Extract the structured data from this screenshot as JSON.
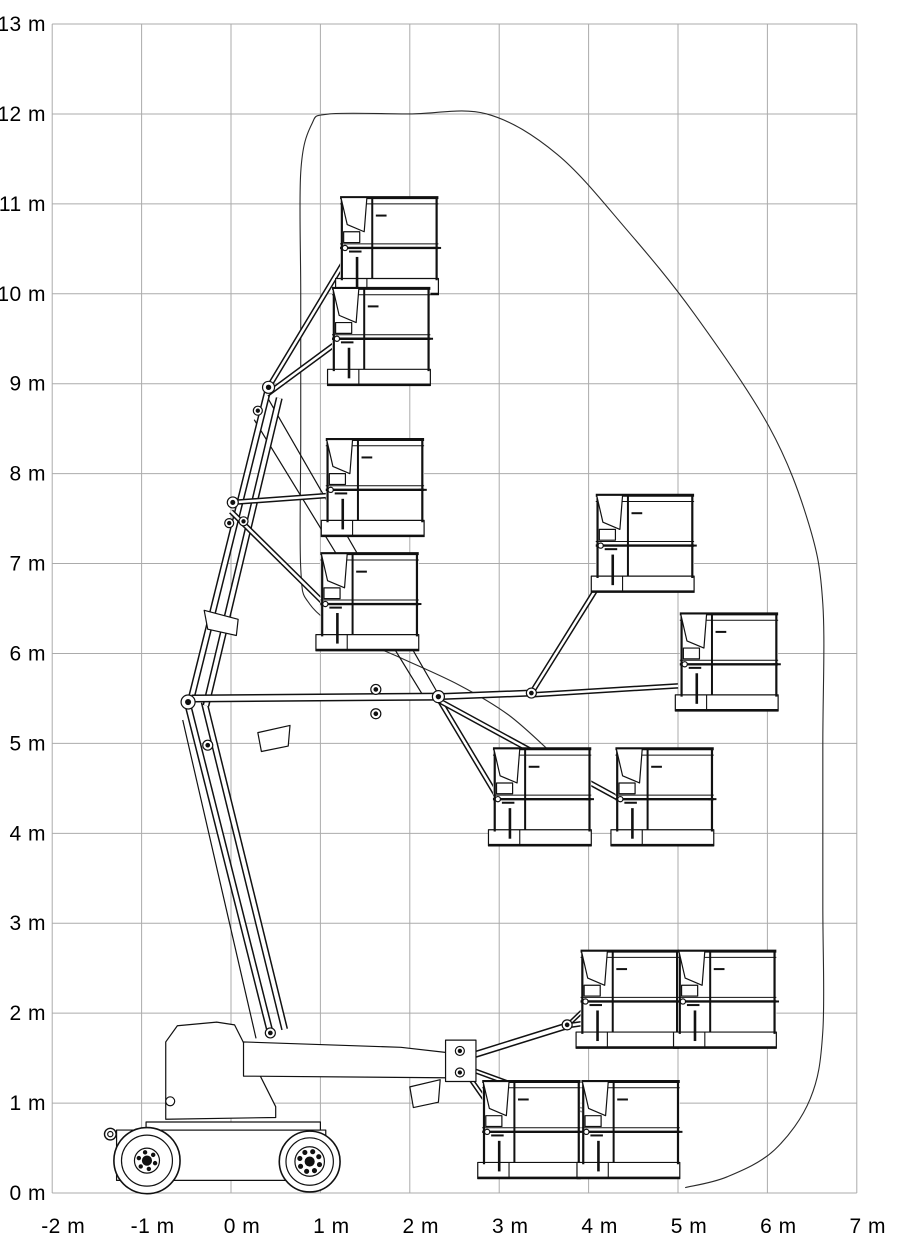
{
  "diagram": {
    "type": "working-range-envelope",
    "units": "m",
    "x_axis": {
      "ticks": [
        {
          "value": -2,
          "label": "-2 m"
        },
        {
          "value": -1,
          "label": "-1 m"
        },
        {
          "value": 0,
          "label": "0 m"
        },
        {
          "value": 1,
          "label": "1 m"
        },
        {
          "value": 2,
          "label": "2 m"
        },
        {
          "value": 3,
          "label": "3 m"
        },
        {
          "value": 4,
          "label": "4 m"
        },
        {
          "value": 5,
          "label": "5 m"
        },
        {
          "value": 6,
          "label": "6 m"
        },
        {
          "value": 7,
          "label": "7 m"
        }
      ]
    },
    "y_axis": {
      "ticks": [
        {
          "value": 0,
          "label": "0 m"
        },
        {
          "value": 1,
          "label": "1 m"
        },
        {
          "value": 2,
          "label": "2 m"
        },
        {
          "value": 3,
          "label": "3 m"
        },
        {
          "value": 4,
          "label": "4 m"
        },
        {
          "value": 5,
          "label": "5 m"
        },
        {
          "value": 6,
          "label": "6 m"
        },
        {
          "value": 7,
          "label": "7 m"
        },
        {
          "value": 8,
          "label": "8 m"
        },
        {
          "value": 9,
          "label": "9 m"
        },
        {
          "value": 10,
          "label": "10 m"
        },
        {
          "value": 11,
          "label": "11 m"
        },
        {
          "value": 12,
          "label": "12 m"
        },
        {
          "value": 13,
          "label": "13 m"
        }
      ]
    },
    "colors": {
      "grid": "#ababab",
      "ink": "#111111",
      "envelope": "#2a2a2a",
      "paper": "#ffffff"
    },
    "envelope_m": [
      [
        3.58,
        4.9
      ],
      [
        3.1,
        5.32
      ],
      [
        2.55,
        5.65
      ],
      [
        1.9,
        5.95
      ],
      [
        1.3,
        6.22
      ],
      [
        0.88,
        6.55
      ],
      [
        0.78,
        6.95
      ],
      [
        0.78,
        8.4
      ],
      [
        0.78,
        10.0
      ],
      [
        0.78,
        11.35
      ],
      [
        0.9,
        11.88
      ],
      [
        1.1,
        12.0
      ],
      [
        2.0,
        12.0
      ],
      [
        2.86,
        12.0
      ],
      [
        3.65,
        11.55
      ],
      [
        4.42,
        10.72
      ],
      [
        5.18,
        9.78
      ],
      [
        6.02,
        8.52
      ],
      [
        6.46,
        7.45
      ],
      [
        6.62,
        6.55
      ],
      [
        6.62,
        5.0
      ],
      [
        6.62,
        3.2
      ],
      [
        6.62,
        1.8
      ],
      [
        6.48,
        1.05
      ],
      [
        6.08,
        0.48
      ],
      [
        5.55,
        0.18
      ],
      [
        5.08,
        0.06
      ]
    ],
    "baskets": {
      "width": 1.1,
      "rail_height": 1.08,
      "positions": [
        {
          "x": 1.22,
          "floor": 9.99
        },
        {
          "x": 1.13,
          "floor": 8.98
        },
        {
          "x": 1.06,
          "floor": 7.3
        },
        {
          "x": 1.0,
          "floor": 6.03
        },
        {
          "x": 4.08,
          "floor": 6.68
        },
        {
          "x": 5.02,
          "floor": 5.36
        },
        {
          "x": 2.93,
          "floor": 3.86
        },
        {
          "x": 4.3,
          "floor": 3.86
        },
        {
          "x": 3.91,
          "floor": 1.61
        },
        {
          "x": 5.0,
          "floor": 1.61
        },
        {
          "x": 2.81,
          "floor": 0.16
        },
        {
          "x": 3.92,
          "floor": 0.16
        }
      ]
    },
    "machine": {
      "booms": [
        [
          0.44,
          1.78,
          -0.48,
          5.42,
          7
        ],
        [
          0.6,
          1.82,
          -0.3,
          5.46,
          7
        ],
        [
          -0.44,
          5.52,
          0.42,
          8.96,
          7
        ],
        [
          -0.28,
          5.42,
          0.54,
          8.84,
          7
        ],
        [
          -0.44,
          5.5,
          2.32,
          5.52,
          8
        ],
        [
          2.32,
          5.52,
          3.36,
          5.56,
          7
        ],
        [
          0.42,
          8.96,
          1.28,
          10.38,
          5.5
        ],
        [
          0.4,
          8.88,
          1.19,
          9.46,
          5.5
        ],
        [
          0.02,
          7.68,
          1.12,
          7.76,
          5.5
        ],
        [
          0.0,
          7.58,
          1.06,
          6.54,
          5.5
        ],
        [
          3.36,
          5.56,
          4.15,
          6.82,
          5.5
        ],
        [
          3.36,
          5.54,
          5.0,
          5.64,
          5.5
        ],
        [
          2.32,
          5.5,
          2.97,
          4.42,
          5.5
        ],
        [
          2.32,
          5.48,
          4.35,
          4.38,
          5.5
        ],
        [
          2.6,
          1.5,
          3.76,
          1.86,
          7
        ],
        [
          3.76,
          1.86,
          3.97,
          2.06,
          4.5
        ],
        [
          3.76,
          1.86,
          5.03,
          2.04,
          5.5
        ],
        [
          2.56,
          1.44,
          2.91,
          0.94,
          5
        ],
        [
          2.56,
          1.42,
          3.99,
          0.9,
          5
        ]
      ],
      "rods": [
        [
          0.4,
          8.86,
          2.3,
          5.58,
          1.2
        ],
        [
          0.26,
          8.6,
          2.18,
          5.48,
          1.2
        ],
        [
          -0.54,
          5.26,
          0.28,
          1.72,
          1.2
        ],
        [
          0.03,
          1.87,
          0.36,
          0.9,
          1.1
        ],
        [
          0.2,
          1.47,
          2.46,
          1.42,
          1.1
        ],
        [
          -0.68,
          1.43,
          -0.55,
          1.47,
          1.6
        ],
        [
          -0.68,
          1.52,
          -0.55,
          1.56,
          1.6
        ],
        [
          -0.68,
          1.61,
          -0.55,
          1.65,
          1.6
        ],
        [
          -0.68,
          1.7,
          -0.55,
          1.74,
          1.6
        ]
      ],
      "polygons": [
        [
          [
            -1.28,
            0.14
          ],
          [
            -1.28,
            0.7
          ],
          [
            1.06,
            0.7
          ],
          [
            1.06,
            0.42
          ],
          [
            0.98,
            0.14
          ]
        ],
        [
          [
            -0.95,
            0.7
          ],
          [
            -0.95,
            0.79
          ],
          [
            1.0,
            0.79
          ],
          [
            1.0,
            0.7
          ]
        ],
        [
          [
            -0.73,
            0.82
          ],
          [
            -0.73,
            1.68
          ],
          [
            -0.6,
            1.86
          ],
          [
            -0.16,
            1.9
          ],
          [
            0.04,
            1.87
          ],
          [
            0.5,
            0.96
          ],
          [
            0.5,
            0.84
          ]
        ],
        [
          [
            0.14,
            1.3
          ],
          [
            0.14,
            1.68
          ],
          [
            1.9,
            1.62
          ],
          [
            2.52,
            1.55
          ],
          [
            2.52,
            1.28
          ]
        ],
        [
          [
            2.4,
            1.24
          ],
          [
            2.4,
            1.7
          ],
          [
            2.74,
            1.7
          ],
          [
            2.74,
            1.24
          ]
        ],
        [
          [
            -0.3,
            6.48
          ],
          [
            0.08,
            6.38
          ],
          [
            0.06,
            6.2
          ],
          [
            -0.26,
            6.27
          ]
        ],
        [
          [
            0.3,
            5.12
          ],
          [
            0.66,
            5.2
          ],
          [
            0.64,
            4.97
          ],
          [
            0.34,
            4.91
          ]
        ],
        [
          [
            2.0,
            1.18
          ],
          [
            2.34,
            1.26
          ],
          [
            2.32,
            1.01
          ],
          [
            2.04,
            0.95
          ]
        ]
      ],
      "pivots": [
        [
          0.42,
          8.96,
          6
        ],
        [
          0.3,
          8.7,
          4.5
        ],
        [
          0.02,
          7.68,
          5.5
        ],
        [
          0.14,
          7.47,
          4.5
        ],
        [
          -0.02,
          7.45,
          4.5
        ],
        [
          -0.48,
          5.46,
          7
        ],
        [
          -0.26,
          4.98,
          5
        ],
        [
          2.32,
          5.52,
          6
        ],
        [
          3.36,
          5.56,
          5
        ],
        [
          1.62,
          5.6,
          5
        ],
        [
          1.62,
          5.33,
          5
        ],
        [
          2.56,
          1.58,
          4.5
        ],
        [
          2.56,
          1.34,
          4.5
        ],
        [
          3.76,
          1.87,
          5
        ],
        [
          0.44,
          1.78,
          5
        ]
      ],
      "wheels": [
        {
          "c": [
            -0.94,
            0.36
          ],
          "r": 0.37,
          "rings": [
            0.285,
            0.14
          ],
          "hub": 0.05,
          "bolts": 6,
          "bolt_rad": 0.095,
          "bolt_r": 0.018
        },
        {
          "c": [
            0.88,
            0.35
          ],
          "r": 0.34,
          "rings": [
            0.265,
            0.165
          ],
          "hub": 0.05,
          "bolts": 8,
          "bolt_rad": 0.115,
          "bolt_r": 0.022
        }
      ],
      "tie_ring": {
        "c": [
          -1.35,
          0.655
        ],
        "r": 0.065
      }
    }
  }
}
